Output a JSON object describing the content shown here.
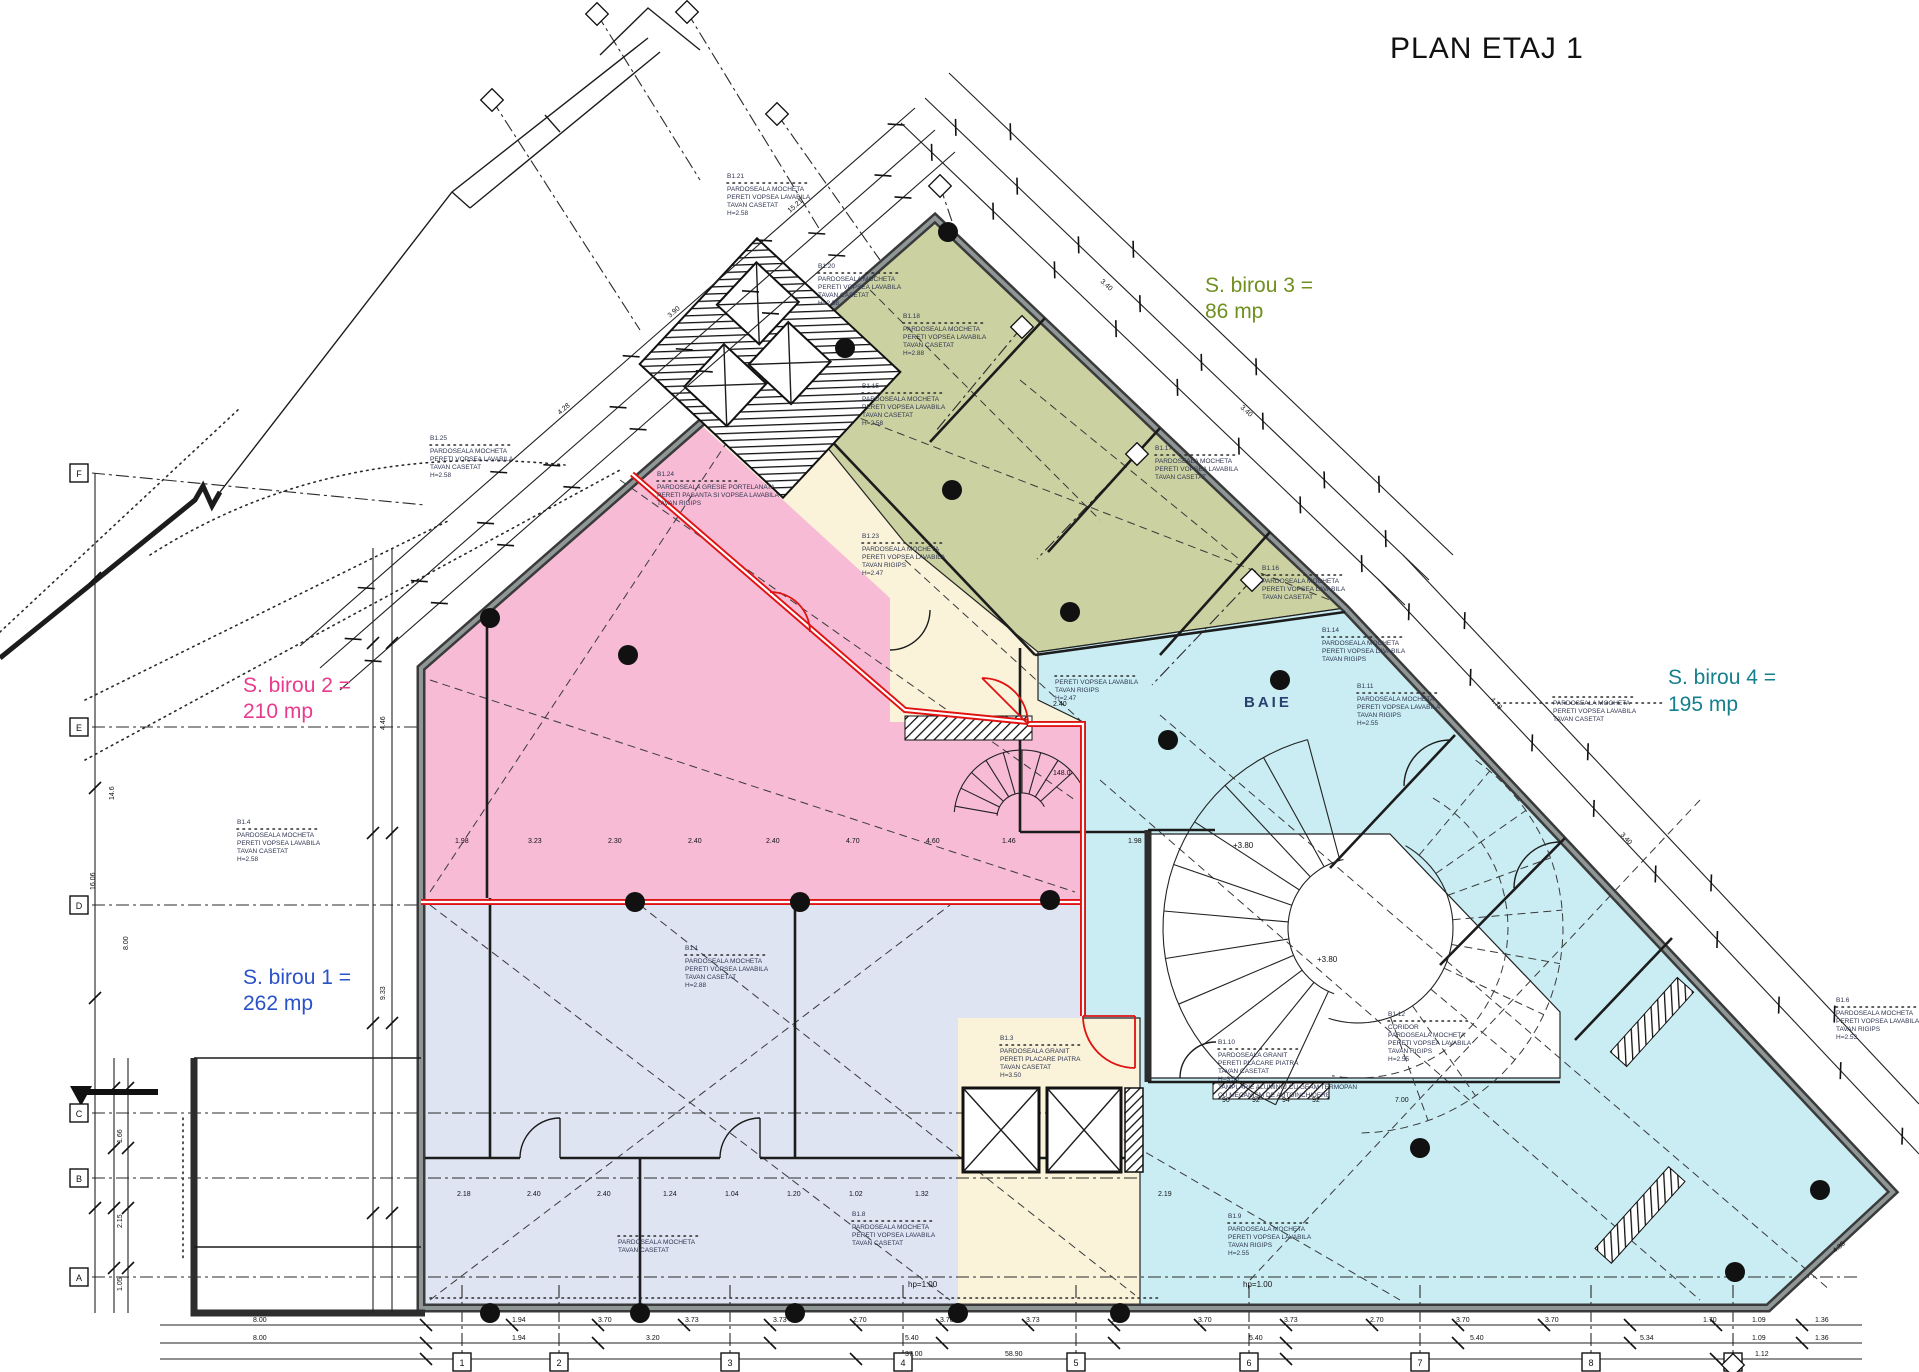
{
  "title": "PLAN ETAJ 1",
  "zones": {
    "birou1": {
      "name": "S. birou 1 =",
      "area": "262 mp",
      "color": "#2a52c8",
      "fill": "#dfe4f3"
    },
    "birou2": {
      "name": "S. birou 2 =",
      "area": "210 mp",
      "color": "#ea3a8c",
      "fill": "#f7bbd5"
    },
    "birou3": {
      "name": "S. birou 3 =",
      "area": "86 mp",
      "color": "#6f8f1f",
      "fill": "#cbd1a1"
    },
    "birou4": {
      "name": "S. birou 4 =",
      "area": "195 mp",
      "color": "#157f8d",
      "fill": "#c9edf3"
    },
    "corridor_fill": "#faf3da",
    "accent_red": "#e01212"
  },
  "baie_label": "BAIE",
  "annotations": [
    {
      "x": 430,
      "y": 440,
      "tag": "B1.25",
      "lines": [
        "PARDOSEALA MOCHETA",
        "PERETI VOPSEA LAVABILA",
        "TAVAN CASETAT",
        "H=2.58"
      ]
    },
    {
      "x": 727,
      "y": 178,
      "tag": "B1.21",
      "lines": [
        "PARDOSEALA MOCHETA",
        "PERETI VOPSEA LAVABILA",
        "TAVAN CASETAT",
        "H=2.58"
      ]
    },
    {
      "x": 818,
      "y": 268,
      "tag": "B1.20",
      "lines": [
        "PARDOSEALA MOCHETA",
        "PERETI VOPSEA LAVABILA",
        "TAVAN CASETAT",
        "H=2.58"
      ]
    },
    {
      "x": 903,
      "y": 318,
      "tag": "B1.18",
      "lines": [
        "PARDOSEALA MOCHETA",
        "PERETI VOPSEA LAVABILA",
        "TAVAN CASETAT",
        "H=2.88"
      ]
    },
    {
      "x": 862,
      "y": 388,
      "tag": "B1.15",
      "lines": [
        "PARDOSEALA MOCHETA",
        "PERETI VOPSEA LAVABILA",
        "TAVAN CASETAT",
        "H=2.58"
      ]
    },
    {
      "x": 1155,
      "y": 450,
      "tag": "B1.17",
      "lines": [
        "PARDOSEALA MOCHETA",
        "PERETI VOPSEA LAVABILA",
        "TAVAN CASETAT"
      ]
    },
    {
      "x": 1262,
      "y": 570,
      "tag": "B1.16",
      "lines": [
        "PARDOSEALA MOCHETA",
        "PERETI VOPSEA LAVABILA",
        "TAVAN CASETAT"
      ]
    },
    {
      "x": 1322,
      "y": 632,
      "tag": "B1.14",
      "lines": [
        "PARDOSEALA MOCHETA",
        "PERETI VOPSEA LAVABILA",
        "TAVAN RIGIPS"
      ]
    },
    {
      "x": 1357,
      "y": 688,
      "tag": "B1.11",
      "lines": [
        "PARDOSEALA MOCHETA",
        "PERETI VOPSEA LAVABILA",
        "TAVAN RIGIPS",
        "H=2.55"
      ]
    },
    {
      "x": 1553,
      "y": 697,
      "tag": "",
      "lines": [
        "PARDOSEALA MOCHETA",
        "PERETI VOPSEA LAVABILA",
        "TAVAN CASETAT"
      ]
    },
    {
      "x": 657,
      "y": 476,
      "tag": "B1.24",
      "lines": [
        "PARDOSEALA GRESIE PORTELANATA",
        "PERETI PASANTA SI VOPSEA LAVABILA",
        "TAVAN RIGIPS"
      ]
    },
    {
      "x": 862,
      "y": 538,
      "tag": "B1.23",
      "lines": [
        "PARDOSEALA MOCHETA",
        "PERETI VOPSEA LAVABILA",
        "TAVAN RIGIPS",
        "H=2.47"
      ]
    },
    {
      "x": 1055,
      "y": 676,
      "tag": "",
      "lines": [
        "PERETI VOPSEA LAVABILA",
        "TAVAN RIGIPS",
        "H=2.47"
      ]
    },
    {
      "x": 237,
      "y": 824,
      "tag": "B1.4",
      "lines": [
        "PARDOSEALA MOCHETA",
        "PERETI VOPSEA LAVABILA",
        "TAVAN CASETAT",
        "H=2.58"
      ]
    },
    {
      "x": 685,
      "y": 950,
      "tag": "B1.1",
      "lines": [
        "PARDOSEALA MOCHETA",
        "PERETI VOPSEA LAVABILA",
        "TAVAN CASETAT",
        "H=2.88"
      ]
    },
    {
      "x": 1000,
      "y": 1040,
      "tag": "B1.3",
      "lines": [
        "PARDOSEALA GRANIT",
        "PERETI PLACARE PIATRA",
        "TAVAN CASETAT",
        "H=3.50"
      ]
    },
    {
      "x": 1388,
      "y": 1016,
      "tag": "B1.12",
      "lines": [
        "CORIDOR",
        "PARDOSEALA MOCHETA",
        "PERETI VOPSEA LAVABILA",
        "TAVAN RIGIPS",
        "H=2.55"
      ]
    },
    {
      "x": 1218,
      "y": 1044,
      "tag": "B1.10",
      "lines": [
        "PARDOSEALA GRANIT",
        "PERETI PLACARE PIATRA",
        "TAVAN CASETAT",
        "H=3.50",
        "TAMPLARIE ALUMINIU CU GEAM TERMOPAN",
        "CU MECANISM DE AUTOINCHIDERE"
      ]
    },
    {
      "x": 618,
      "y": 1236,
      "tag": "",
      "lines": [
        "PARDOSEALA MOCHETA",
        "TAVAN CASETAT"
      ]
    },
    {
      "x": 852,
      "y": 1216,
      "tag": "B1.8",
      "lines": [
        "PARDOSEALA MOCHETA",
        "PERETI VOPSEA LAVABILA",
        "TAVAN CASETAT"
      ]
    },
    {
      "x": 1228,
      "y": 1218,
      "tag": "B1.9",
      "lines": [
        "PARDOSEALA MOCHETA",
        "PERETI VOPSEA LAVABILA",
        "TAVAN RIGIPS",
        "H=2.55"
      ]
    },
    {
      "x": 1836,
      "y": 1002,
      "tag": "B1.6",
      "lines": [
        "PARDOSEALA MOCHETA",
        "PERETI VOPSEA LAVABILA",
        "TAVAN RIGIPS",
        "H=2.53"
      ]
    }
  ],
  "dim_labels": [
    {
      "x": 512,
      "y": 1322,
      "t": "1.94"
    },
    {
      "x": 598,
      "y": 1322,
      "t": "3.70"
    },
    {
      "x": 685,
      "y": 1322,
      "t": "3.73"
    },
    {
      "x": 773,
      "y": 1322,
      "t": "3.73"
    },
    {
      "x": 853,
      "y": 1322,
      "t": "2.70"
    },
    {
      "x": 940,
      "y": 1322,
      "t": "3.70"
    },
    {
      "x": 1026,
      "y": 1322,
      "t": "3.73"
    },
    {
      "x": 1112,
      "y": 1322,
      "t": "2.70"
    },
    {
      "x": 1198,
      "y": 1322,
      "t": "3.70"
    },
    {
      "x": 1284,
      "y": 1322,
      "t": "3.73"
    },
    {
      "x": 1370,
      "y": 1322,
      "t": "2.70"
    },
    {
      "x": 1456,
      "y": 1322,
      "t": "3.70"
    },
    {
      "x": 1545,
      "y": 1322,
      "t": "3.70"
    },
    {
      "x": 1703,
      "y": 1322,
      "t": "1.70"
    },
    {
      "x": 1752,
      "y": 1322,
      "t": "1.09"
    },
    {
      "x": 1815,
      "y": 1322,
      "t": "1.36"
    },
    {
      "x": 253,
      "y": 1322,
      "t": "8.00"
    },
    {
      "x": 253,
      "y": 1340,
      "t": "8.00"
    },
    {
      "x": 512,
      "y": 1340,
      "t": "1.94"
    },
    {
      "x": 646,
      "y": 1340,
      "t": "3.20"
    },
    {
      "x": 905,
      "y": 1340,
      "t": "5.40"
    },
    {
      "x": 1249,
      "y": 1340,
      "t": "5.40"
    },
    {
      "x": 1470,
      "y": 1340,
      "t": "5.40"
    },
    {
      "x": 1640,
      "y": 1340,
      "t": "5.34"
    },
    {
      "x": 1752,
      "y": 1340,
      "t": "1.09"
    },
    {
      "x": 1815,
      "y": 1340,
      "t": "1.36"
    },
    {
      "x": 905,
      "y": 1356,
      "t": "37.00"
    },
    {
      "x": 1005,
      "y": 1356,
      "t": "58.90"
    },
    {
      "x": 1755,
      "y": 1356,
      "t": "1.12"
    },
    {
      "x": 455,
      "y": 843,
      "t": "1.98"
    },
    {
      "x": 528,
      "y": 843,
      "t": "3.23"
    },
    {
      "x": 608,
      "y": 843,
      "t": "2.30"
    },
    {
      "x": 688,
      "y": 843,
      "t": "2.40"
    },
    {
      "x": 766,
      "y": 843,
      "t": "2.40"
    },
    {
      "x": 846,
      "y": 843,
      "t": "4.70"
    },
    {
      "x": 926,
      "y": 843,
      "t": "4.60"
    },
    {
      "x": 1002,
      "y": 843,
      "t": "1.46"
    },
    {
      "x": 1053,
      "y": 706,
      "t": "2.40"
    },
    {
      "x": 1053,
      "y": 775,
      "t": "148.0"
    },
    {
      "x": 1128,
      "y": 843,
      "t": "1.98"
    },
    {
      "x": 457,
      "y": 1196,
      "t": "2.18"
    },
    {
      "x": 527,
      "y": 1196,
      "t": "2.40"
    },
    {
      "x": 597,
      "y": 1196,
      "t": "2.40"
    },
    {
      "x": 663,
      "y": 1196,
      "t": "1.24"
    },
    {
      "x": 725,
      "y": 1196,
      "t": "1.04"
    },
    {
      "x": 787,
      "y": 1196,
      "t": "1.20"
    },
    {
      "x": 849,
      "y": 1196,
      "t": "1.02"
    },
    {
      "x": 915,
      "y": 1196,
      "t": "1.32"
    },
    {
      "x": 1158,
      "y": 1196,
      "t": "2.19"
    },
    {
      "x": 1222,
      "y": 1102,
      "t": "90"
    },
    {
      "x": 1252,
      "y": 1102,
      "t": "92"
    },
    {
      "x": 1282,
      "y": 1102,
      "t": "94"
    },
    {
      "x": 1312,
      "y": 1102,
      "t": "92"
    },
    {
      "x": 1395,
      "y": 1102,
      "t": "7.00"
    },
    {
      "x": 95,
      "y": 890,
      "t": "16.06",
      "r": -90
    },
    {
      "x": 114,
      "y": 800,
      "t": "14.6",
      "r": -90
    },
    {
      "x": 128,
      "y": 950,
      "t": "8.00",
      "r": -90
    },
    {
      "x": 122,
      "y": 1143,
      "t": "1.66",
      "r": -90
    },
    {
      "x": 122,
      "y": 1228,
      "t": "2.15",
      "r": -90
    },
    {
      "x": 122,
      "y": 1291,
      "t": "1.05",
      "r": -90
    },
    {
      "x": 385,
      "y": 730,
      "t": "4.46",
      "r": -90
    },
    {
      "x": 385,
      "y": 1000,
      "t": "9.33",
      "r": -90
    },
    {
      "x": 560,
      "y": 415,
      "t": "4.28",
      "r": -41
    },
    {
      "x": 670,
      "y": 318,
      "t": "3.90",
      "r": -41
    },
    {
      "x": 790,
      "y": 213,
      "t": "15.21",
      "r": -41
    },
    {
      "x": 1100,
      "y": 282,
      "t": "3.40",
      "r": 42
    },
    {
      "x": 1240,
      "y": 408,
      "t": "3.40",
      "r": 42
    },
    {
      "x": 1490,
      "y": 700,
      "t": "4.78",
      "r": 47
    },
    {
      "x": 1620,
      "y": 835,
      "t": "3.40",
      "r": 47
    },
    {
      "x": 1835,
      "y": 1253,
      "t": "4.35",
      "r": -40
    }
  ],
  "levels": [
    {
      "x": 1233,
      "y": 848,
      "t": "+3.80"
    },
    {
      "x": 1317,
      "y": 962,
      "t": "+3.80"
    },
    {
      "x": 908,
      "y": 1287,
      "t": "hp=1.00"
    },
    {
      "x": 1243,
      "y": 1287,
      "t": "hp=1.00"
    }
  ],
  "grid": {
    "bottom": [
      {
        "x": 462,
        "label": "1"
      },
      {
        "x": 559,
        "label": "2"
      },
      {
        "x": 730,
        "label": "3"
      },
      {
        "x": 903,
        "label": "4"
      },
      {
        "x": 1076,
        "label": "5"
      },
      {
        "x": 1249,
        "label": "6"
      },
      {
        "x": 1420,
        "label": "7"
      },
      {
        "x": 1591,
        "label": "8"
      },
      {
        "x": 1733,
        "label": "9"
      }
    ],
    "left": [
      {
        "y": 473,
        "label": "F"
      },
      {
        "y": 727,
        "label": "E"
      },
      {
        "y": 905,
        "label": "D"
      },
      {
        "y": 1113,
        "label": "C"
      },
      {
        "y": 1178,
        "label": "B"
      },
      {
        "y": 1277,
        "label": "A"
      }
    ]
  }
}
